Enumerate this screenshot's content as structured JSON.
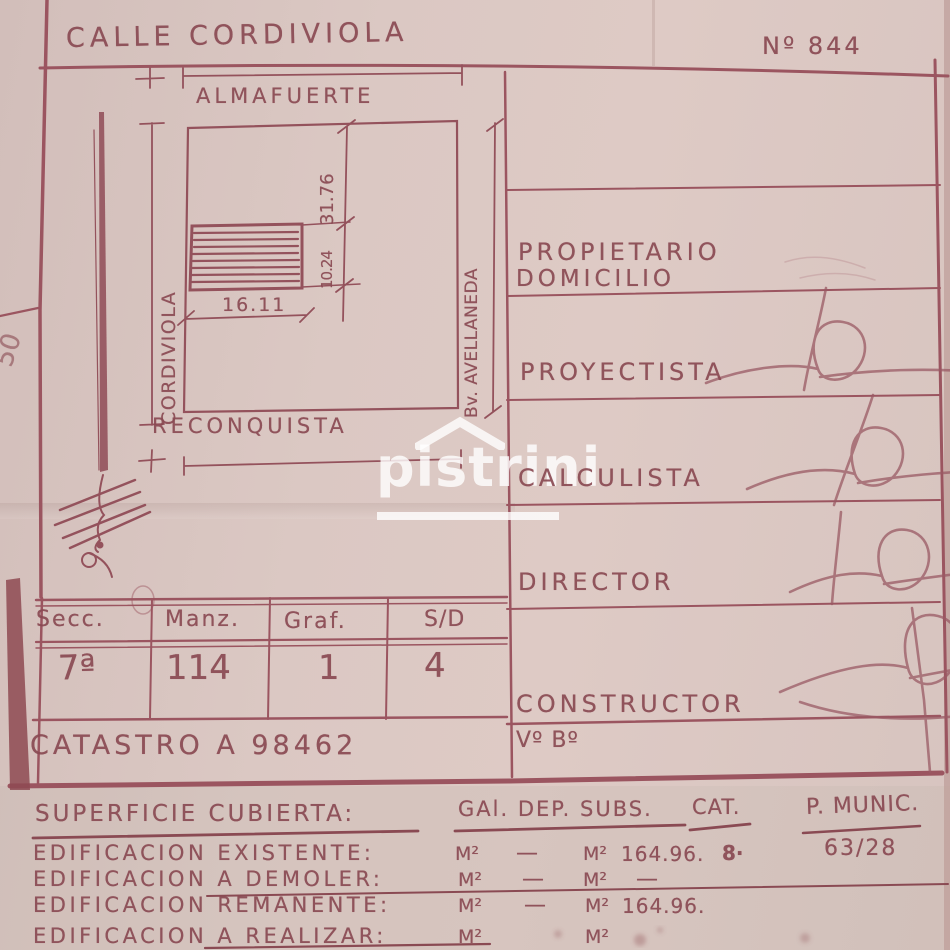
{
  "colors": {
    "paper": "#d9c5c0",
    "ink": "#8a4a53",
    "line": "#9b5560",
    "watermark": "#ffffff"
  },
  "header": {
    "street_top": "CALLE CORDIVIOLA",
    "plan_number": "Nº 844"
  },
  "site_plan": {
    "street_inner": "ALMAFUERTE",
    "street_left": "CORDIVIOLA",
    "street_bottom": "RECONQUISTA",
    "street_right": "Bv. AVELLANEDA",
    "dim_lot_depth": "31.76",
    "dim_building_depth": "10.24",
    "dim_building_width": "16.11",
    "edge_mark": "50"
  },
  "watermark": {
    "text": "pistrini"
  },
  "roles": {
    "propietario": "PROPIETARIO",
    "domicilio": "DOMICILIO",
    "proyectista": "PROYECTISTA",
    "calculista": "CALCULISTA",
    "director": "DIRECTOR",
    "constructor": "CONSTRUCTOR",
    "visto_bueno": "Vº Bº"
  },
  "cadastre_table": {
    "headers": [
      "Secc.",
      "Manz.",
      "Graf.",
      "S/D"
    ],
    "values": [
      "7ª",
      "114",
      "1",
      "4"
    ],
    "catastro": "CATASTRO  A 98462"
  },
  "surface": {
    "title": "SUPERFICIE CUBIERTA:",
    "col_group": "GAl. DEP. SUBS.",
    "col_cat": "CAT.",
    "permit_label": "P. MUNIC.",
    "permit_number": "63/28",
    "rows": [
      {
        "label": "EDIFICACION EXISTENTE:",
        "m2_1": "M²",
        "v1": "—",
        "m2_2": "M²",
        "v2": "164.96.",
        "cat": "8·"
      },
      {
        "label": "EDIFICACION A DEMOLER:",
        "m2_1": "M²",
        "v1": "—",
        "m2_2": "M²",
        "v2": "—",
        "cat": ""
      },
      {
        "label": "EDIFICACION REMANENTE:",
        "m2_1": "M²",
        "v1": "—",
        "m2_2": "M²",
        "v2": "164.96.",
        "cat": ""
      },
      {
        "label": "EDIFICACION A REALIZAR:",
        "m2_1": "M²",
        "v1": "",
        "m2_2": "M²",
        "v2": "",
        "cat": ""
      }
    ]
  }
}
